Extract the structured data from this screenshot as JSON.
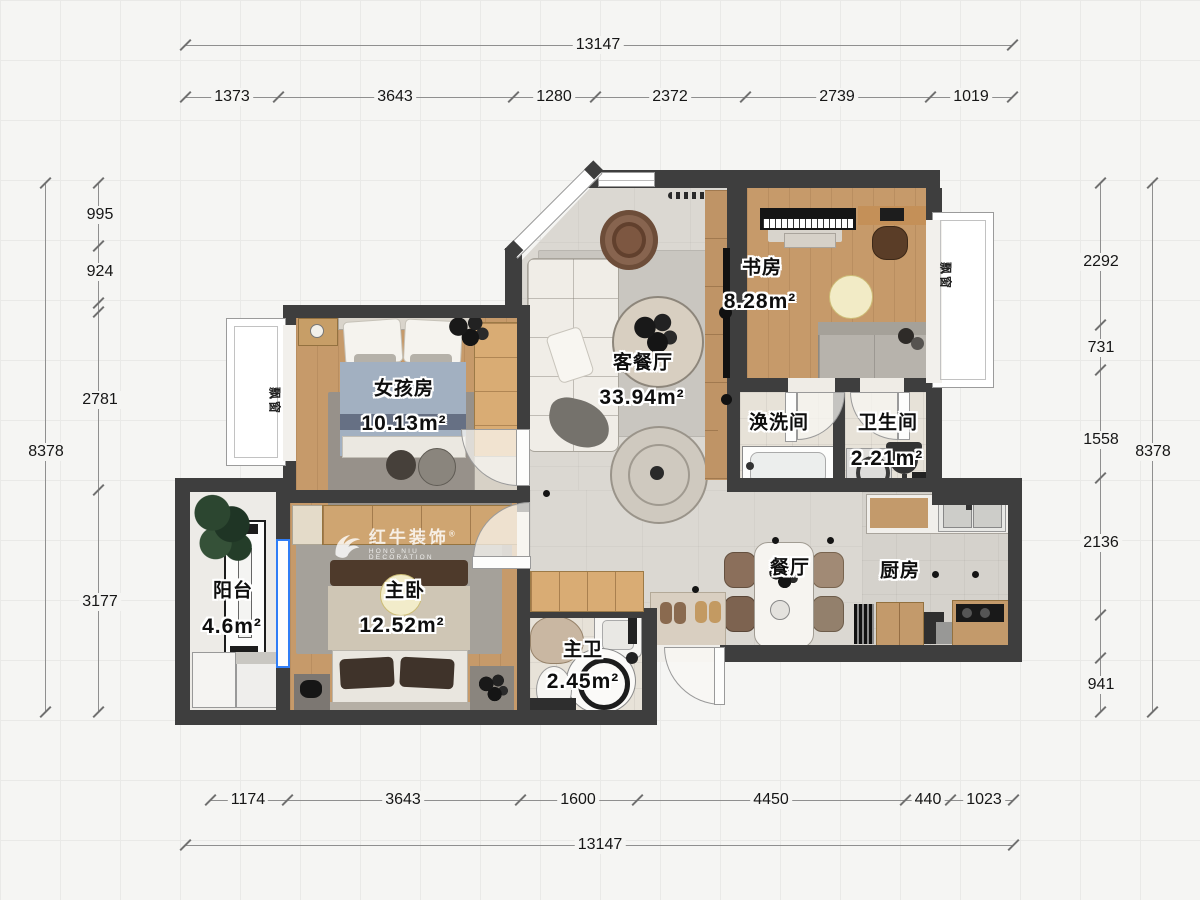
{
  "colors": {
    "wall": "#3e3e3e",
    "wood": "#c69a6a",
    "window_accent": "#2f7df6",
    "background": "#f5f5f3"
  },
  "watermark": {
    "brand": "红牛装饰",
    "sub": "HONG NIU DECORATION",
    "reg": "®"
  },
  "bay_window_label": "飘窗",
  "rooms": {
    "study": {
      "name": "书房",
      "area": "8.28m²"
    },
    "living": {
      "name": "客餐厅",
      "area": "33.94m²"
    },
    "girl": {
      "name": "女孩房",
      "area": "10.13m²"
    },
    "wash": {
      "name": "涣洗间"
    },
    "bath": {
      "name": "卫生间",
      "area": "2.21m²"
    },
    "balcony": {
      "name": "阳台",
      "area": "4.6m²"
    },
    "master": {
      "name": "主卧",
      "area": "12.52m²"
    },
    "masterbath": {
      "name": "主卫",
      "area": "2.45m²"
    },
    "dining": {
      "name": "餐厅"
    },
    "kitchen": {
      "name": "厨房"
    }
  },
  "dims": {
    "top_total": "13147",
    "top": [
      "1373",
      "3643",
      "1280",
      "2372",
      "2739",
      "1019"
    ],
    "left": [
      "995",
      "924",
      "2781",
      "3177"
    ],
    "left_total": "8378",
    "right": [
      "2292",
      "731",
      "1558",
      "2136",
      "941"
    ],
    "right_total": "8378",
    "bottom": [
      "1174",
      "3643",
      "1600",
      "4450",
      "440",
      "1023"
    ],
    "bottom_total": "13147"
  }
}
